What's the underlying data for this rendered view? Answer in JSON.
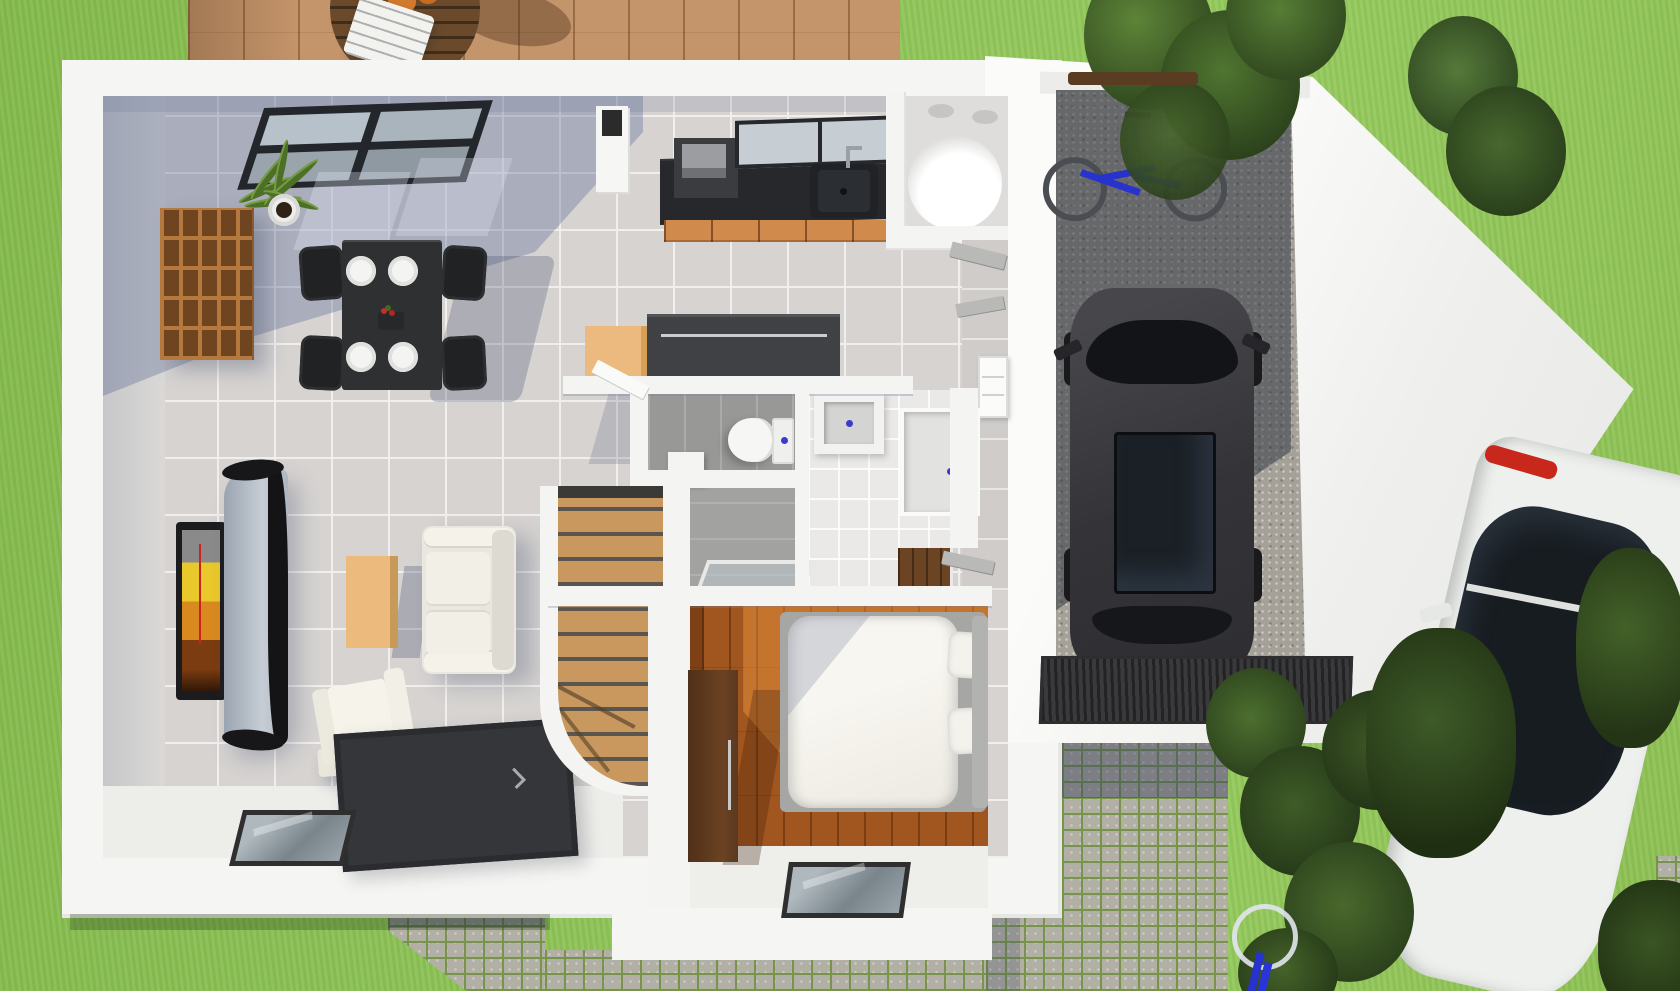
{
  "image": {
    "kind": "3D rendered top-down floor plan of a single-storey house with garage, garden, deck and driveway",
    "width": 1680,
    "height": 991
  },
  "palette": {
    "lawn_green": "#8dc053",
    "deck_wood": "#c4946a",
    "wall_white": "#f5f5f3",
    "tile_floor": "#d6d3d1",
    "shadow_blue": "rgba(90,104,145,0.35)",
    "bedroom_wood": "#a2561f",
    "stair_wood": "#c9985e",
    "kitchen_cabinet_orange": "#d08a4c",
    "counter_dark": "#26282b",
    "island_dark": "#3f4144",
    "island_cabinet_tan": "#ecb97e",
    "gravel_gray": "#a5a198",
    "cobblestone": "#b2afa5",
    "moss_joint_green": "#77944b",
    "rug_dark": "#34363a",
    "garage_car_gray": "#3a3a3e",
    "street_car_white": "#eef0ee",
    "taillight_red": "#c8281c",
    "bike_blue": "#2832cc",
    "tree_green": "#3f5c2a",
    "drain_dot_blue": "#3b3bc8",
    "tv_screen_yellow": "#e8c82a"
  },
  "outdoor": {
    "lawn": {
      "label": "Lawn"
    },
    "deck": {
      "label": "Wood deck terrace",
      "furniture": [
        "round slatted wooden table",
        "white slatted chair"
      ]
    },
    "driveway": {
      "label": "Cobblestone driveway"
    },
    "entrance_path": {
      "label": "Cobblestone entrance path"
    },
    "south_strip": {
      "label": "Cobblestone strip along south wall"
    },
    "vegetation": [
      "tree cluster north-east of garage",
      "brown hedge behind garage",
      "shrub row along driveway",
      "trees overhanging parked car"
    ]
  },
  "house": {
    "rooms": [
      {
        "name": "living-dining",
        "label": "Living / dining room",
        "floor": "light gray tile",
        "furniture": [
          "cube shelving unit",
          "potted plant",
          "roof window on floor",
          "dark dining table",
          "four black chairs",
          "four white plates",
          "flower centerpiece",
          "wall TV with yellow picture",
          "curved TV unit",
          "light wood coffee table",
          "white two-seat sofa",
          "white armchair",
          "dark gray rug",
          "glass floor panel"
        ]
      },
      {
        "name": "kitchen",
        "label": "Kitchen",
        "furniture": [
          "dark countertop",
          "sink with faucet",
          "orange drawer cabinets",
          "oven block",
          "window above sink",
          "chimney column",
          "kitchen island with tan cabinet"
        ]
      },
      {
        "name": "tub-room",
        "label": "Bathroom with round tub",
        "furniture": [
          "white cylindrical tub",
          "ceiling spots"
        ]
      },
      {
        "name": "wc",
        "label": "WC",
        "floor": "dark gray tile",
        "furniture": [
          "toilet with cistern",
          "waste bin",
          "glass door panel"
        ]
      },
      {
        "name": "shower-room",
        "label": "Shower room",
        "floor": "white tile",
        "furniture": [
          "washbasin with blue drain",
          "shower tray with blue drain"
        ]
      },
      {
        "name": "hallway",
        "label": "Hallway",
        "furniture": [
          "open gray doors",
          "white sideboard"
        ]
      },
      {
        "name": "stairs",
        "label": "Wooden staircase with curved lower end"
      },
      {
        "name": "bedroom",
        "label": "Bedroom",
        "floor": "dark wood planks",
        "furniture": [
          "double bed with white duvet",
          "two pillows",
          "gray bed frame",
          "dark wardrobe",
          "glass floor panel"
        ]
      },
      {
        "name": "garage",
        "label": "Garage",
        "floor": "gravel",
        "contents": [
          "dark gray car",
          "blue bicycle",
          "ribbed entrance mat"
        ]
      }
    ]
  },
  "vehicles": [
    {
      "name": "garage-car",
      "label": "Dark gray car parked in garage"
    },
    {
      "name": "street-car",
      "label": "White car with red taillight parked on driveway"
    },
    {
      "name": "garage-bicycle",
      "label": "Blue bicycle in garage"
    },
    {
      "name": "yard-bicycle",
      "label": "Bicycle wheel in the yard"
    }
  ]
}
